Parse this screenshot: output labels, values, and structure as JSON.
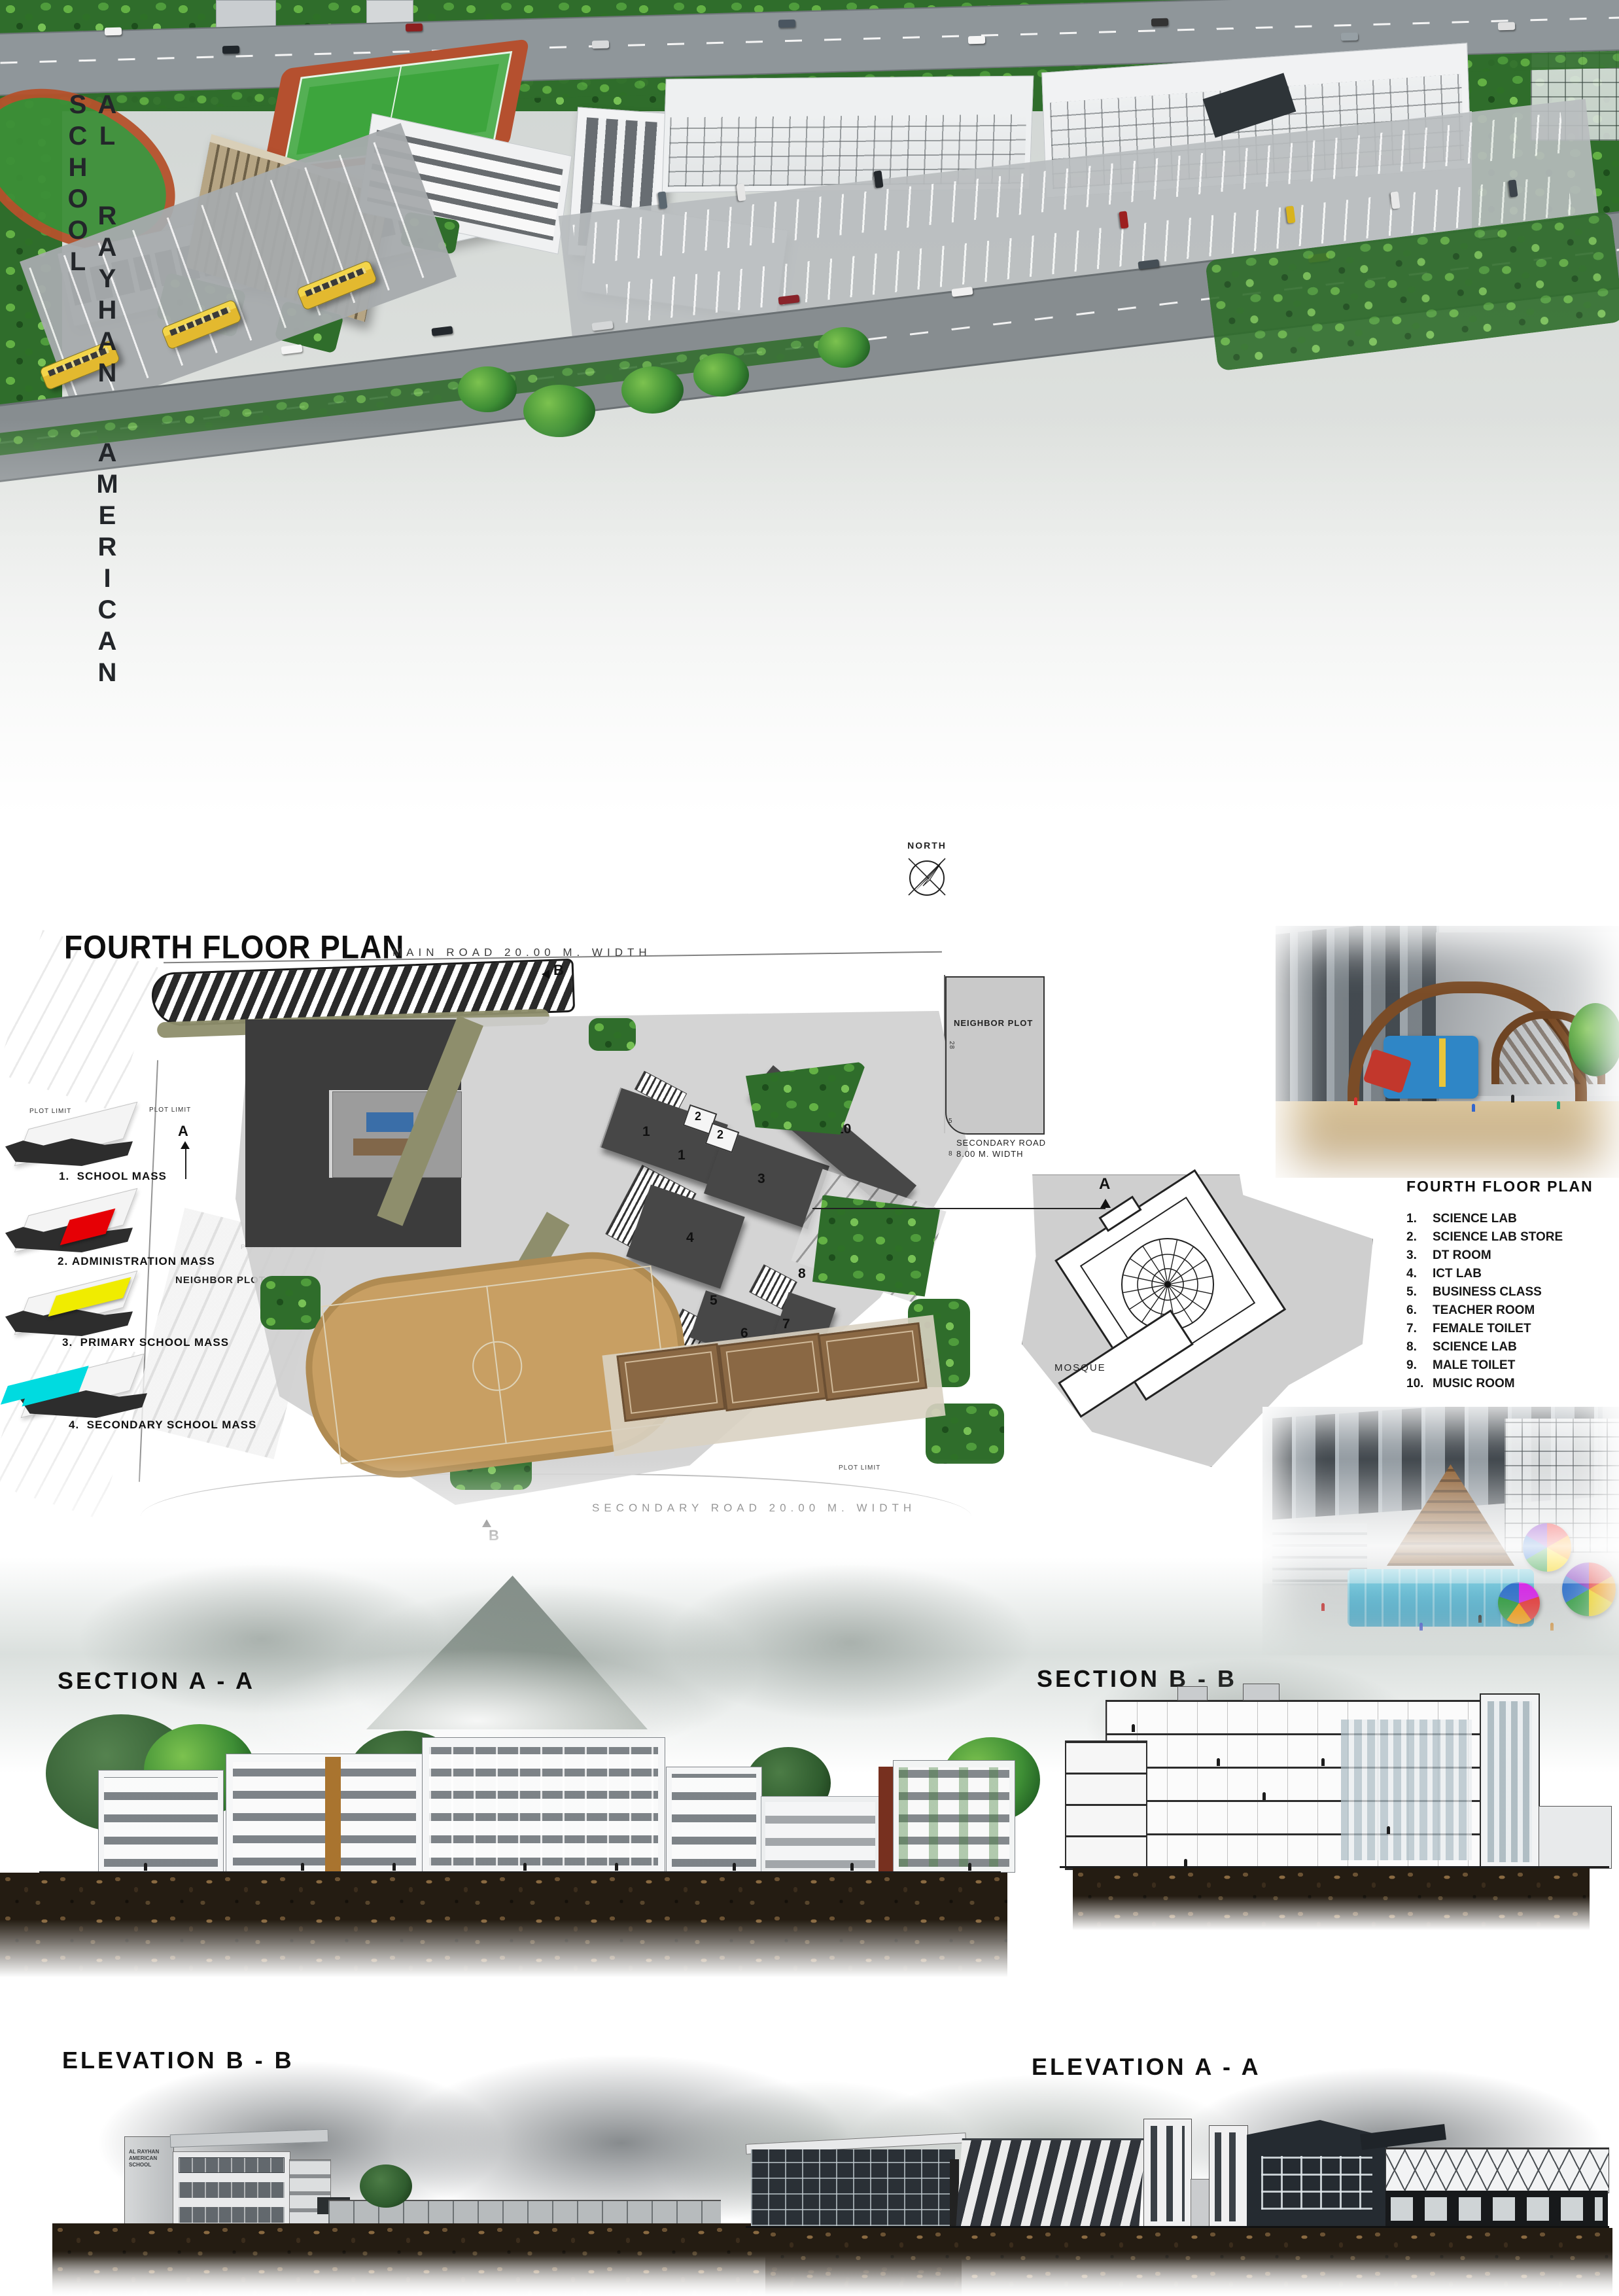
{
  "board": {
    "school_name": "AL RAYHAN AMERICAN SCHOOL"
  },
  "plan": {
    "title": "FOURTH FLOOR PLAN",
    "north_label": "NORTH",
    "main_road_label": "MAIN ROAD 20.00 M. WIDTH",
    "secondary_road_20_label": "SECONDARY ROAD 20.00 M. WIDTH",
    "secondary_road_8_line1": "SECONDARY ROAD",
    "secondary_road_8_line2": "8.00 M. WIDTH",
    "neighbor_plot_label": "NEIGHBOR PLOT",
    "mosque_label": "MOSQUE",
    "plot_limit_label": "PLOT LIMIT",
    "marker_a": "A",
    "marker_b": "B",
    "neighbor_dims": [
      "28",
      "5",
      "8"
    ],
    "room_numbers": [
      "1",
      "1",
      "2",
      "2",
      "3",
      "10",
      "4",
      "2",
      "2",
      "8",
      "8",
      "5",
      "5",
      "6",
      "7"
    ]
  },
  "masses": [
    {
      "num": "1.",
      "label": "SCHOOL MASS",
      "color": "#2e2e2e"
    },
    {
      "num": "2.",
      "label": "ADMINISTRATION MASS",
      "color": "#e60005"
    },
    {
      "num": "3.",
      "label": "PRIMARY SCHOOL MASS",
      "color": "#f0ec00"
    },
    {
      "num": "4.",
      "label": "SECONDARY SCHOOL MASS",
      "color": "#00dbe0"
    }
  ],
  "legend": {
    "title": "FOURTH FLOOR PLAN",
    "items": [
      {
        "num": "1.",
        "label": "SCIENCE LAB"
      },
      {
        "num": "2.",
        "label": "SCIENCE LAB STORE"
      },
      {
        "num": "3.",
        "label": "DT ROOM"
      },
      {
        "num": "4.",
        "label": "ICT LAB"
      },
      {
        "num": "5.",
        "label": "BUSINESS CLASS"
      },
      {
        "num": "6.",
        "label": "TEACHER ROOM"
      },
      {
        "num": "7.",
        "label": "FEMALE TOILET"
      },
      {
        "num": "8.",
        "label": "SCIENCE LAB"
      },
      {
        "num": "9.",
        "label": "MALE TOILET"
      },
      {
        "num": "10.",
        "label": "MUSIC ROOM"
      }
    ]
  },
  "sections": {
    "a_label": "SECTION  A - A",
    "b_label": "SECTION  B - B"
  },
  "elevations": {
    "b_label": "ELEVATION  B - B",
    "a_label": "ELEVATION  A - A",
    "sign_lines": [
      "AL RAYHAN",
      "AMERICAN",
      "SCHOOL"
    ]
  },
  "colors": {
    "admin_red": "#e60005",
    "primary_yellow": "#f0ec00",
    "secondary_cyan": "#00dbe0",
    "mass_dark": "#2e2e2e",
    "plan_building": "#474747",
    "olive_band": "#8e8e6c",
    "pitch_tan": "#c89f63",
    "court_brown": "#8a6844",
    "field_green": "#3da53d",
    "bus_yellow": "#e8c437"
  }
}
